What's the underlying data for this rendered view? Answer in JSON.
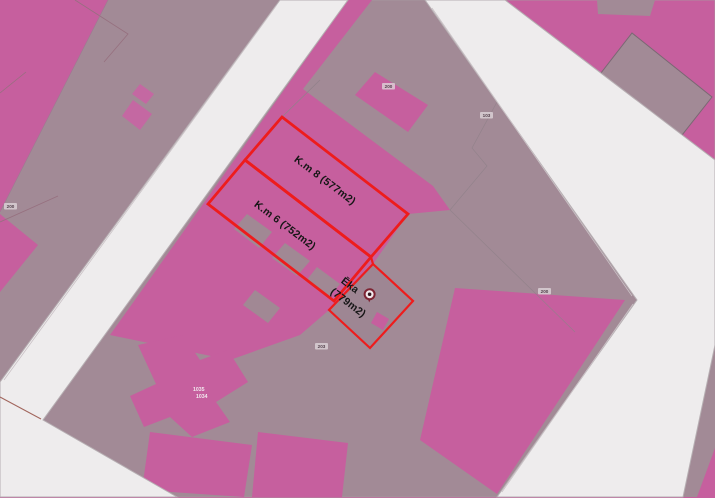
{
  "map_type": "cadastral-parcel-map",
  "parcels": [
    {
      "label": "K.m 8 (577m2)",
      "area": "577m2"
    },
    {
      "label": "K.m 6 (752m2)",
      "area": "752m2"
    }
  ],
  "building": {
    "line1": "Ēka",
    "line2": "(779m2)",
    "area": "779m2",
    "marker_icon": "location-pin-icon"
  },
  "small_labels": [
    {
      "text": "200"
    },
    {
      "text": "103"
    },
    {
      "text": "200"
    },
    {
      "text": "200"
    },
    {
      "text": "203"
    }
  ],
  "stacked_label": {
    "line1": "1035",
    "line2": "1034"
  },
  "colors": {
    "parcel_pink": "#c65f9e",
    "built_area_mauve": "#a28a96",
    "road_white": "#eeeced",
    "highlight_red": "#ee1c1c",
    "label_text": "#161616"
  }
}
